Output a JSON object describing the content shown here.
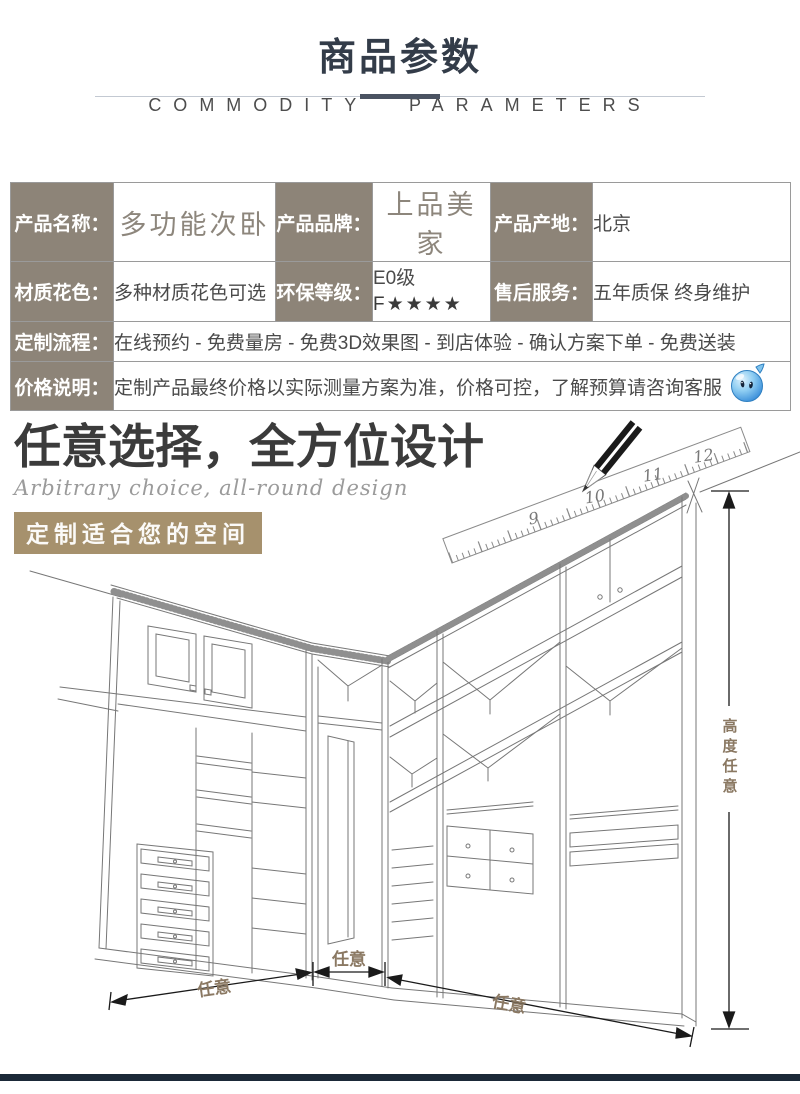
{
  "page": {
    "title": "商品参数",
    "subtitle": "COMMODITY PARAMETERS"
  },
  "params_table": {
    "rows": [
      {
        "cells": [
          {
            "label": "产品名称：",
            "value": "多功能次卧"
          },
          {
            "label": "产品品牌：",
            "value": "上品美家"
          },
          {
            "label": "产品产地：",
            "value": "北京"
          }
        ]
      },
      {
        "cells": [
          {
            "label": "材质花色：",
            "value": "多种材质花色可选"
          },
          {
            "label": "环保等级：",
            "value": "E0级",
            "value2": "F★★★★"
          },
          {
            "label": "售后服务：",
            "value": "五年质保 终身维护"
          }
        ]
      },
      {
        "label": "定制流程：",
        "value": "在线预约 - 免费量房 - 免费3D效果图 - 到店体验 - 确认方案下单 - 免费送装"
      },
      {
        "label": "价格说明：",
        "value": "定制产品最终价格以实际测量方案为准，价格可控，了解预算请咨询客服"
      }
    ]
  },
  "design_section": {
    "heading": "任意选择，全方位设计",
    "subheading": "Arbitrary choice, all-round design",
    "tagline": "定制适合您的空间",
    "ruler_numbers": [
      "9",
      "10",
      "11",
      "12"
    ],
    "dims": {
      "width_left": "任意",
      "width_middle": "任意",
      "width_right": "任意",
      "height": "高度任意"
    }
  },
  "icons": {
    "mascot": "water-drop-customer-service-mascot",
    "pencil": "pencil-sketch-icon",
    "ruler": "ruler-icon"
  },
  "colors": {
    "label_bg": "#8d8478",
    "title": "#333c49",
    "divider_dark": "#4a5362",
    "dim_label": "#8a7862",
    "mascot_blue": "#3f9be0",
    "footer": "#1b2938",
    "line_art": "#777777"
  }
}
